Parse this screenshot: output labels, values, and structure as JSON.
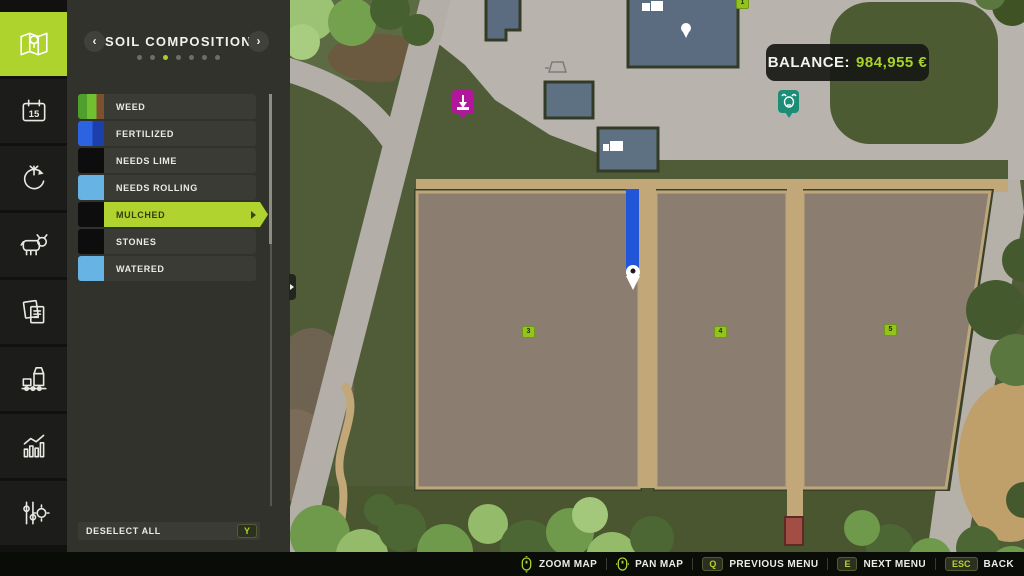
{
  "sidebar": {
    "tabs": [
      {
        "name": "map",
        "active": true
      },
      {
        "name": "calendar",
        "active": false,
        "day": "15"
      },
      {
        "name": "crop-rotation",
        "active": false
      },
      {
        "name": "animals",
        "active": false
      },
      {
        "name": "contracts",
        "active": false
      },
      {
        "name": "production",
        "active": false
      },
      {
        "name": "statistics",
        "active": false
      },
      {
        "name": "settings",
        "active": false
      }
    ]
  },
  "panel": {
    "title": "SOIL COMPOSITION",
    "pagination": {
      "total": 7,
      "active_index": 2
    },
    "legend": [
      {
        "label": "WEED",
        "swatch": "linear-gradient(90deg,#4f9e2e 0%,#4f9e2e 35%,#72c030 35%,#72c030 72%,#7d5030 72%)"
      },
      {
        "label": "FERTILIZED",
        "swatch": "linear-gradient(90deg,#2b63e0 0%,#2b63e0 55%,#1c3fae 55%)"
      },
      {
        "label": "NEEDS LIME",
        "swatch": "#0d0d0d"
      },
      {
        "label": "NEEDS ROLLING",
        "swatch": "#67b4e4"
      },
      {
        "label": "MULCHED",
        "swatch": "#0d0d0d",
        "selected": true
      },
      {
        "label": "STONES",
        "swatch": "#0d0d0d"
      },
      {
        "label": "WATERED",
        "swatch": "#67b4e4"
      }
    ],
    "deselect_all": {
      "label": "DESELECT ALL",
      "key": "Y"
    }
  },
  "map": {
    "balance": {
      "label": "BALANCE:",
      "value": "984,955 €"
    },
    "field_labels": [
      "1",
      "3",
      "4",
      "5"
    ]
  },
  "hud": {
    "hints": [
      {
        "icon": "mouse-wheel",
        "label": "ZOOM MAP"
      },
      {
        "icon": "mouse",
        "label": "PAN MAP"
      },
      {
        "key": "Q",
        "label": "PREVIOUS MENU"
      },
      {
        "key": "E",
        "label": "NEXT MENU"
      },
      {
        "key": "ESC",
        "label": "BACK"
      }
    ]
  },
  "colors": {
    "accent": "#aed32c",
    "balance_value": "#a8d32b",
    "panel_bg": "#32322c"
  }
}
